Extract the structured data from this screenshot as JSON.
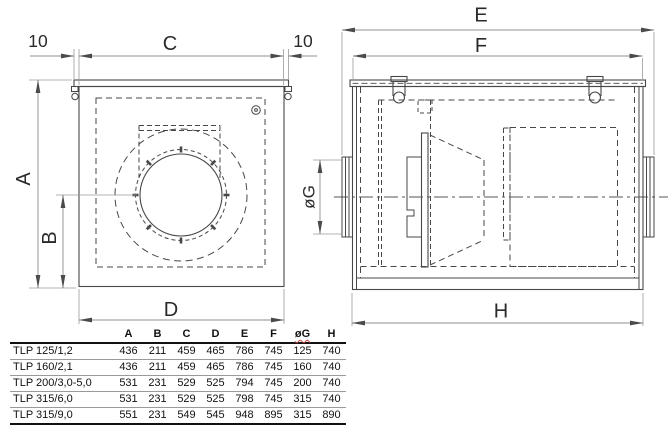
{
  "drawing": {
    "front_view": {
      "label_overhang_left": "10",
      "label_width_top": "C",
      "label_overhang_right": "10",
      "label_height": "A",
      "label_axis_height": "B",
      "label_width_bottom": "D"
    },
    "side_view": {
      "label_length_total": "E",
      "label_length_body": "F",
      "label_duct_diameter": "øG",
      "label_length_base": "H"
    }
  },
  "table": {
    "model_column_header": "",
    "columns": [
      "A",
      "B",
      "C",
      "D",
      "E",
      "F",
      "øG",
      "H"
    ],
    "rows": [
      {
        "model": "TLP 125/1,2",
        "values": [
          "436",
          "211",
          "459",
          "465",
          "786",
          "745",
          "125",
          "740"
        ]
      },
      {
        "model": "TLP 160/2,1",
        "values": [
          "436",
          "211",
          "459",
          "465",
          "786",
          "745",
          "160",
          "740"
        ]
      },
      {
        "model": "TLP 200/3,0-5,0",
        "values": [
          "531",
          "231",
          "529",
          "525",
          "794",
          "745",
          "200",
          "740"
        ]
      },
      {
        "model": "TLP 315/6,0",
        "values": [
          "531",
          "231",
          "529",
          "525",
          "798",
          "745",
          "315",
          "740"
        ]
      },
      {
        "model": "TLP 315/9,0",
        "values": [
          "551",
          "231",
          "549",
          "545",
          "948",
          "895",
          "315",
          "890"
        ]
      }
    ]
  },
  "colors": {
    "line": "#474747",
    "dim_line": "#8f8f8f",
    "text": "#2a2a2a",
    "table_rule": "#111111"
  }
}
